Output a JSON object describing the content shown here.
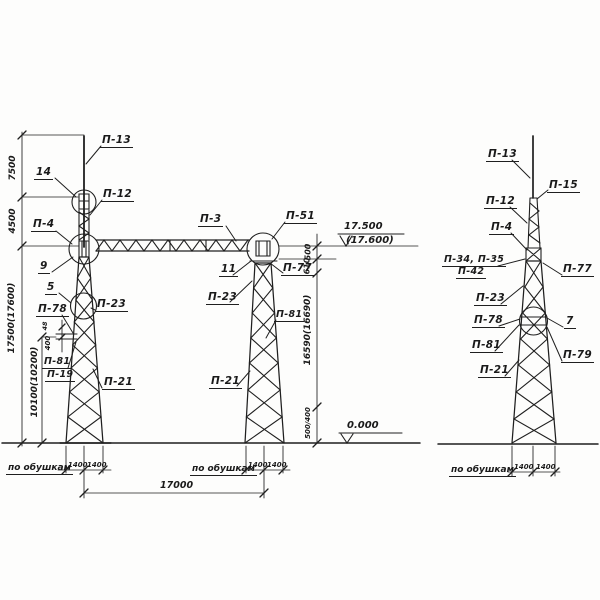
{
  "parts": {
    "p13": "П-13",
    "p12": "П-12",
    "p4": "П-4",
    "p3": "П-3",
    "p51": "П-51",
    "p77": "П-77",
    "p23": "П-23",
    "p78": "П-78",
    "p81": "П-81",
    "p19": "П-19",
    "p21": "П-21",
    "p15": "П-15",
    "p34_35": "П-34, П-35",
    "p42": "П-42",
    "p79": "П-79",
    "n14": "14",
    "n9": "9",
    "n5": "5",
    "n11": "11",
    "n7": "7"
  },
  "dims": {
    "v7500": "7500",
    "v4500": "4500",
    "v17500": "17500(17600)",
    "v10100": "10100(10200)",
    "v48": "48",
    "v400": "400",
    "v500": "500",
    "v610": "610",
    "v16590": "16590(16690)",
    "v500_400": "500/400",
    "h17000": "17000",
    "h1400": "1400"
  },
  "levels": {
    "traverse": "17.500",
    "traverse_alt": "(17.600)",
    "ground": "0.000"
  },
  "notes": {
    "flats": "по обушкам"
  }
}
